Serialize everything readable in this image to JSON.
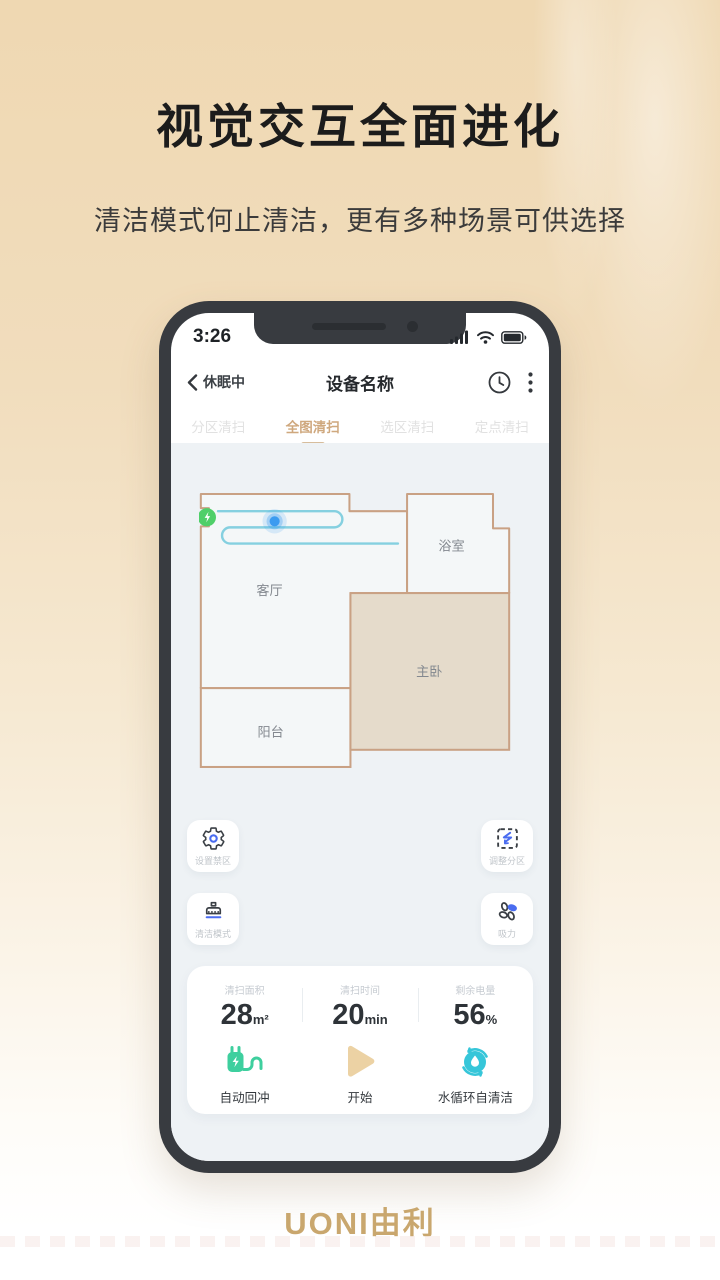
{
  "hero": {
    "title": "视觉交互全面进化",
    "subtitle": "清洁模式何止清洁，更有多种场景可供选择"
  },
  "phone": {
    "status": {
      "time": "3:26"
    },
    "nav": {
      "back_label": "休眠中",
      "title": "设备名称"
    },
    "tabs": [
      {
        "label": "分区清扫",
        "active": false
      },
      {
        "label": "全图清扫",
        "active": true
      },
      {
        "label": "选区清扫",
        "active": false
      },
      {
        "label": "定点清扫",
        "active": false
      }
    ],
    "map": {
      "rooms": [
        {
          "name": "客厅"
        },
        {
          "name": "浴室"
        },
        {
          "name": "主卧"
        },
        {
          "name": "阳台"
        }
      ],
      "dock": "charging-dock",
      "robot": "robot-position"
    },
    "buttons": [
      {
        "label": "设置禁区",
        "icon": "gear-icon"
      },
      {
        "label": "调整分区",
        "icon": "partition-adjust-icon"
      },
      {
        "label": "清洁模式",
        "icon": "brush-icon"
      },
      {
        "label": "吸力",
        "icon": "fan-icon"
      }
    ],
    "stats": {
      "items": [
        {
          "label": "清扫面积",
          "value": "28",
          "unit": "m²"
        },
        {
          "label": "清扫时间",
          "value": "20",
          "unit": "min"
        },
        {
          "label": "剩余电量",
          "value": "56",
          "unit": "%"
        }
      ]
    },
    "actions": [
      {
        "label": "自动回冲",
        "icon": "recharge-plug-icon"
      },
      {
        "label": "开始",
        "icon": "play-icon"
      },
      {
        "label": "水循环自清洁",
        "icon": "self-clean-icon"
      }
    ]
  },
  "footer": {
    "logo": "UONI由利"
  },
  "colors": {
    "accent_gold": "#cfa87e",
    "map_wall": "#c9a184",
    "room_light": "#f4f7f8",
    "room_tan": "#e5dbcb",
    "path_teal": "#85d0e0",
    "robot_blue": "#3b9bf0",
    "dock_green": "#4fcf69",
    "plug_green": "#3ecf9e",
    "play_tan": "#ecd2a4",
    "clean_teal": "#36c6d9",
    "icon_blue": "#4a6cf0"
  }
}
